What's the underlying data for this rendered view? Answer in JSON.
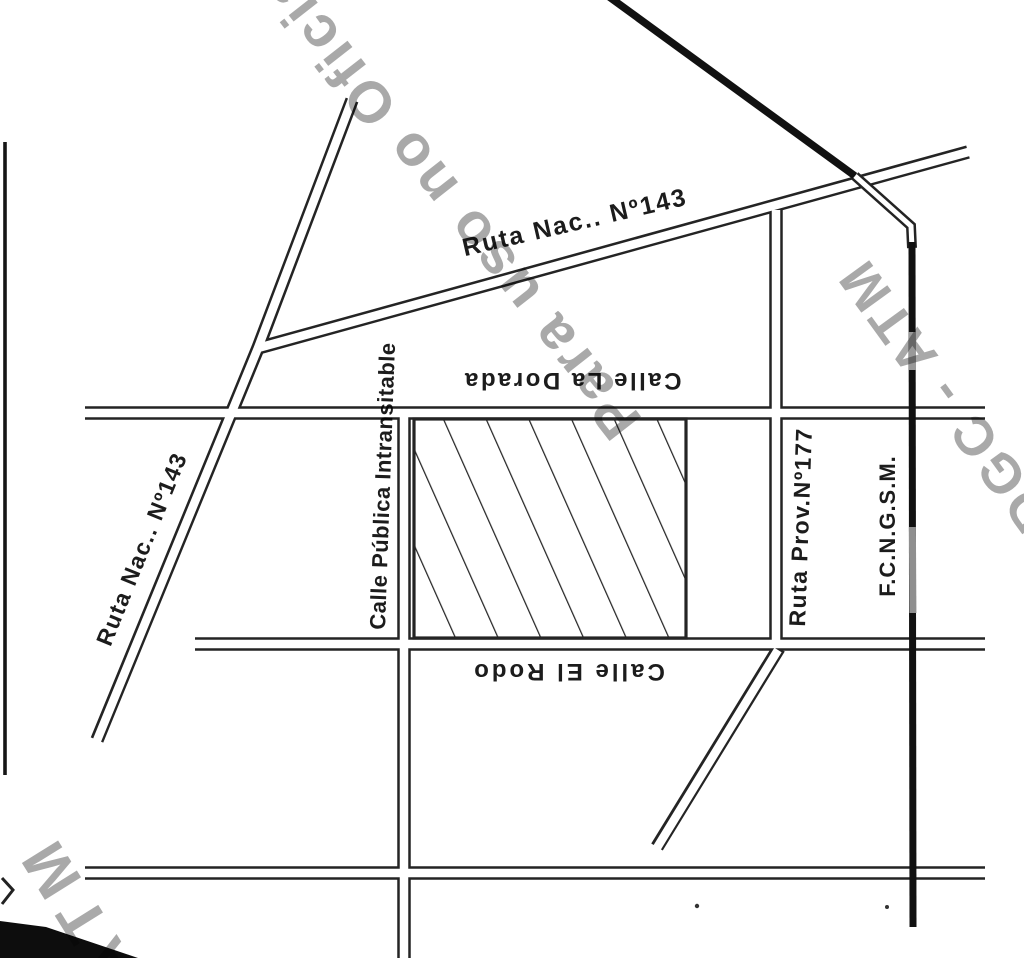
{
  "map": {
    "street_labels": {
      "ruta_nac_top": "Ruta Nac.. Nº143",
      "ruta_nac_left": "Ruta Nac.. Nº143",
      "calle_publica": "Calle Pública Intransitable",
      "calle_la_dorada": "Calle La Dorada",
      "calle_el_rodo": "Calle El Rodo",
      "ruta_prov": "Ruta Prov.Nº177",
      "railway": "F.C.N.G.S.M."
    },
    "watermarks": {
      "diagonal_top": "Para uso no Oficial",
      "diagonal_right": "DGC - ATM",
      "diagonal_bottom_left": "ATM"
    },
    "colors": {
      "ink": "#242424",
      "railway_black": "#111111",
      "watermark_gray": "#a5a5a5",
      "paper": "#ffffff"
    }
  }
}
